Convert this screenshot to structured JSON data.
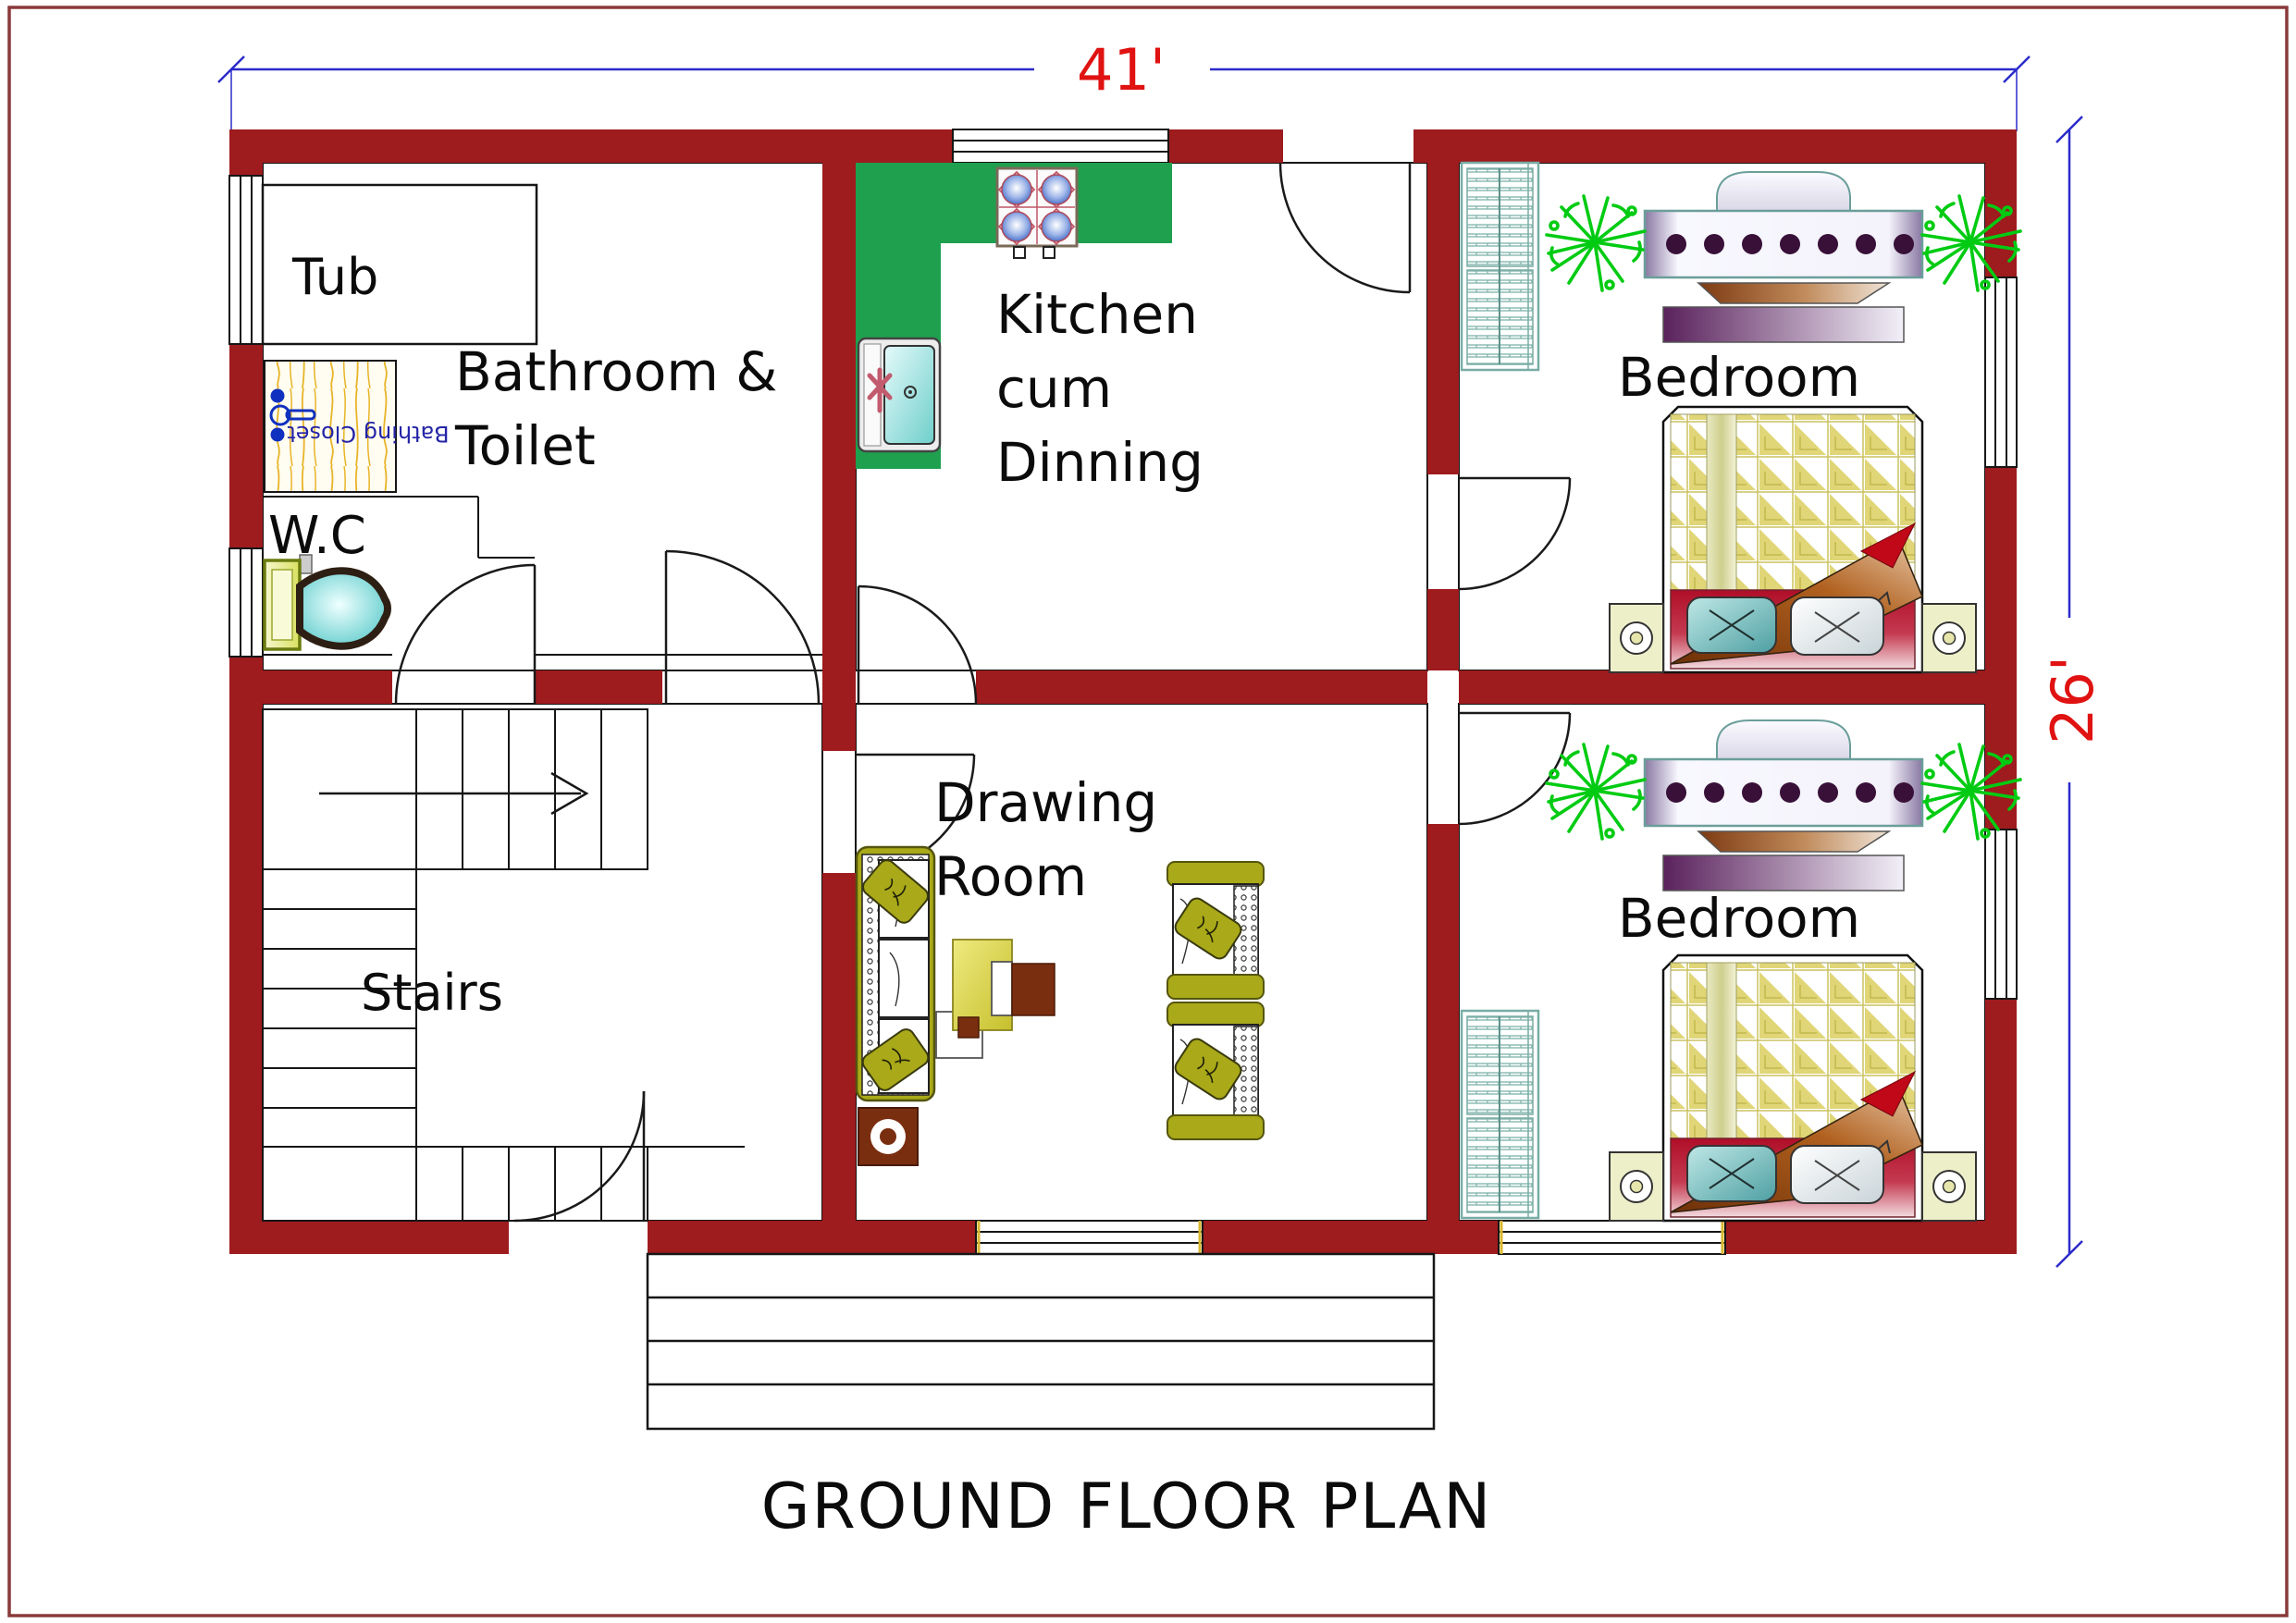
{
  "title": "GROUND FLOOR PLAN",
  "dimensions": {
    "width_label": "41'",
    "height_label": "26'"
  },
  "rooms": {
    "bathroom": {
      "label_line1": "Bathroom &",
      "label_line2": "Toilet"
    },
    "tub": {
      "label": "Tub"
    },
    "wc": {
      "label": "W.C"
    },
    "bathing_closet": {
      "label": "Bathing Closet"
    },
    "kitchen": {
      "label_line1": "Kitchen",
      "label_line2": "cum",
      "label_line3": "Dinning"
    },
    "bedroom_top": {
      "label": "Bedroom"
    },
    "bedroom_bottom": {
      "label": "Bedroom"
    },
    "drawing_room": {
      "label_line1": "Drawing",
      "label_line2": "Room"
    },
    "stairs": {
      "label": "Stairs"
    }
  },
  "colors": {
    "wall": "#9E1B1E",
    "page_border": "#8A3A3A",
    "counter": "#1FA04E",
    "dimension_line": "#2B2BCB",
    "dimension_text": "#E01212",
    "label_text": "#0B0B0B",
    "plant": "#00CB12",
    "mat_text": "#2424A8",
    "olive": "#A9A919"
  }
}
